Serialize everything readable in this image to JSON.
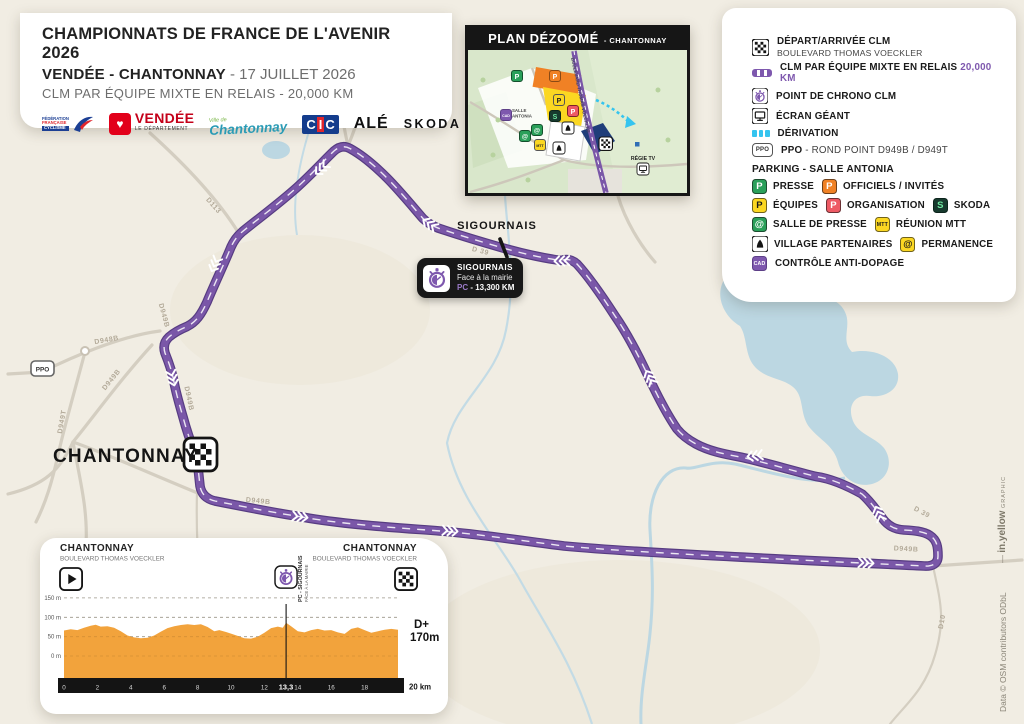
{
  "title_card": {
    "line1": "CHAMPIONNATS DE FRANCE DE L'AVENIR 2026",
    "line2_bold": "VENDÉE - CHANTONNAY",
    "line2_rest": " - 17 JUILLET 2026",
    "line3": "CLM PAR ÉQUIPE MIXTE EN RELAIS - 20,000 KM",
    "logos": {
      "ffc_line1": "FÉDÉRATION",
      "ffc_line2": "FRANÇAISE",
      "ffc_line3": "CYCLISME",
      "vendee": "VENDÉE",
      "vendee_sub": "LE DÉPARTEMENT",
      "chantonnay_sub": "Ville de",
      "chantonnay": "Chantonnay",
      "cic_c1": "C",
      "cic_i": "I",
      "cic_c2": "C",
      "ale": "ALÉ",
      "skoda": "SKODA"
    }
  },
  "inset": {
    "title": "PLAN DÉZOOMÉ",
    "subtitle": "- CHANTONNAY",
    "street": "BOULEVARD THOMAS VOECKLER",
    "salle_line1": "SALLE",
    "salle_line2": "ANTONIA",
    "regie": "RÉGIE TV"
  },
  "legend": {
    "depart_title": "DÉPART/ARRIVÉE CLM",
    "depart_sub": "BOULEVARD THOMAS VOECKLER",
    "clm_label": "CLM PAR ÉQUIPE MIXTE EN RELAIS",
    "clm_km": "20,000 KM",
    "chrono": "POINT DE CHRONO CLM",
    "ecran": "ÉCRAN GÉANT",
    "derivation": "DÉRIVATION",
    "ppo_bold": "PPO",
    "ppo_rest": " - ROND POINT D949B / D949T",
    "parking_header": "PARKING - SALLE ANTONIA",
    "presse": "PRESSE",
    "officiels": "OFFICIELS / INVITÉS",
    "equipes": "ÉQUIPES",
    "organisation": "ORGANISATION",
    "skoda": "SKODA",
    "salle_presse": "SALLE DE PRESSE",
    "mtt_label": "RÉUNION MTT",
    "village": "VILLAGE PARTENAIRES",
    "permanence": "PERMANENCE",
    "cad": "CONTRÔLE ANTI-DOPAGE",
    "icon_texts": {
      "ppo": "PPO",
      "p": "P",
      "at": "@",
      "s": "S",
      "mtt": "MTT",
      "cad": "CAD"
    }
  },
  "callout": {
    "title": "SIGOURNAIS",
    "sub": "Face à la mairie",
    "pc": "PC",
    "km": " - 13,300 KM"
  },
  "map": {
    "towns": {
      "chantonnay": "CHANTONNAY",
      "sigournais": "SIGOURNAIS"
    },
    "ppo": "PPO",
    "road_labels": [
      {
        "text": "D948B",
        "x": 107,
        "y": 342,
        "rot": -10
      },
      {
        "text": "D949B",
        "x": 113,
        "y": 381,
        "rot": -51
      },
      {
        "text": "D949T",
        "x": 64,
        "y": 422,
        "rot": -80
      },
      {
        "text": "D113",
        "x": 212,
        "y": 207,
        "rot": 48
      },
      {
        "text": "D949B",
        "x": 162,
        "y": 316,
        "rot": 75
      },
      {
        "text": "D949B",
        "x": 187,
        "y": 399,
        "rot": 78
      },
      {
        "text": "D949B",
        "x": 258,
        "y": 503,
        "rot": 6
      },
      {
        "text": "D 39",
        "x": 480,
        "y": 253,
        "rot": 14
      },
      {
        "text": "D 39",
        "x": 921,
        "y": 514,
        "rot": 28
      },
      {
        "text": "D949B",
        "x": 906,
        "y": 551,
        "rot": 3
      },
      {
        "text": "D10",
        "x": 944,
        "y": 622,
        "rot": -80
      }
    ]
  },
  "credits": {
    "graphic_prefix": "— ",
    "graphic_name": "in.yellow",
    "graphic_suffix": " GRAPHIC",
    "data": "Data © OSM contributors ODbL"
  },
  "profile": {
    "start_name": "CHANTONNAY",
    "start_sub": "BOULEVARD THOMAS VOECKLER",
    "end_name": "CHANTONNAY",
    "end_sub": "BOULEVARD THOMAS VOECKLER",
    "pc_line1": "PC - SIGOURNAIS",
    "pc_line2": "FACE À LA MAIRIE",
    "dplus_label": "D+",
    "dplus_value": "170m",
    "end_distance": "20 km",
    "pc_tick": "13,3"
  },
  "chart_data": {
    "type": "area",
    "title": "Profil CLM par équipe mixte en relais - Chantonnay",
    "xlabel": "km",
    "ylabel": "m",
    "xlim": [
      0,
      20
    ],
    "ylim": [
      0,
      150
    ],
    "grid": true,
    "y_ticks": [
      "150 m",
      "100 m",
      "50 m",
      "0 m"
    ],
    "y_tick_values": [
      150,
      100,
      50,
      0
    ],
    "x_ticks": [
      0,
      2,
      4,
      6,
      8,
      10,
      12,
      14,
      16,
      18
    ],
    "special_tick_km": 13.3,
    "special_tick_label": "13,3",
    "total_km": 20,
    "dplus_m": 170,
    "fill_color": "#f2a33c",
    "x": [
      0,
      0.4,
      0.8,
      1.2,
      1.6,
      1.9,
      2.2,
      2.6,
      3,
      3.4,
      3.8,
      4.2,
      4.6,
      5,
      5.4,
      5.8,
      6.2,
      6.6,
      7,
      7.4,
      7.8,
      8.2,
      8.6,
      9,
      9.3,
      9.7,
      10,
      10.4,
      10.8,
      11.2,
      11.6,
      12,
      12.4,
      12.8,
      13.1,
      13.3,
      13.6,
      14,
      14.4,
      14.8,
      15.2,
      15.6,
      16,
      16.4,
      16.8,
      17.2,
      17.6,
      18,
      18.4,
      18.8,
      19.2,
      19.6,
      20
    ],
    "elevation_m": [
      66,
      69,
      67,
      73,
      78,
      81,
      76,
      77,
      73,
      64,
      53,
      48,
      46,
      47,
      53,
      63,
      72,
      77,
      80,
      82,
      80,
      82,
      75,
      64,
      67,
      62,
      58,
      52,
      46,
      45,
      50,
      60,
      72,
      76,
      73,
      86,
      77,
      64,
      61,
      67,
      70,
      66,
      67,
      61,
      57,
      70,
      74,
      67,
      60,
      64,
      68,
      70,
      68
    ]
  },
  "colors": {
    "route": "#7a57a8",
    "route_casing": "#573c82",
    "water": "#bcd7e2",
    "road": "#d4cec1",
    "bg": "#f1ede3",
    "derivation": "#35c4ef",
    "accent_purple": "#7e58ae",
    "profile_fill": "#f2a33c"
  }
}
